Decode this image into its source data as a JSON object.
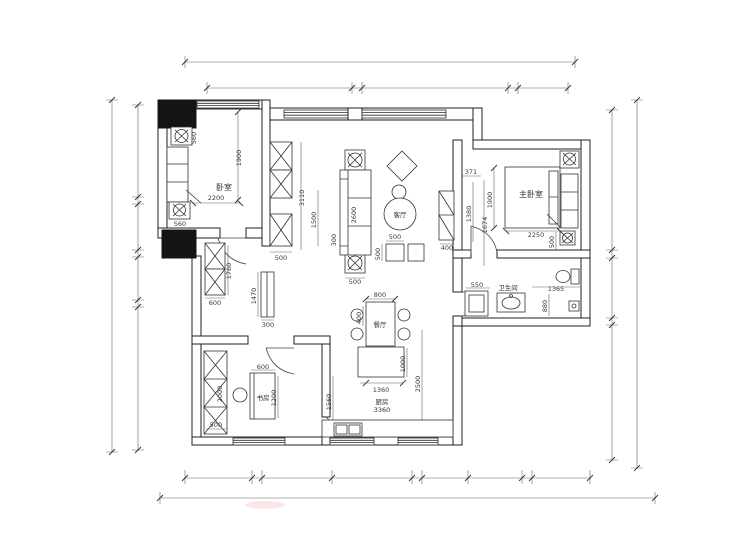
{
  "drawing": {
    "type": "apartment-floor-plan"
  },
  "rooms": {
    "guest_bedroom": "卧室",
    "living_room": "客厅",
    "master_bedroom": "主卧室",
    "bathroom": "卫生间",
    "dining_room": "餐厅",
    "kitchen": "厨房",
    "kitchen_dim": "3360",
    "study": "书房"
  },
  "dims": {
    "d2200": "2200",
    "d1900": "1900",
    "d560": "560",
    "d3110": "3110",
    "d500": "500",
    "d1760": "1760",
    "d600": "600",
    "d1470": "1470",
    "d300": "300",
    "d1500": "1500",
    "d2600": "2600",
    "d400": "400",
    "d371": "371",
    "d1380": "1380",
    "d1674": "1674",
    "d2250": "2250",
    "d550": "550",
    "d1365": "1365",
    "d880": "880",
    "d800": "800",
    "d1000": "1000",
    "d1360": "1360",
    "d2500": "2500",
    "d1560": "1560",
    "d1200": "1200",
    "d2000": "2000"
  }
}
